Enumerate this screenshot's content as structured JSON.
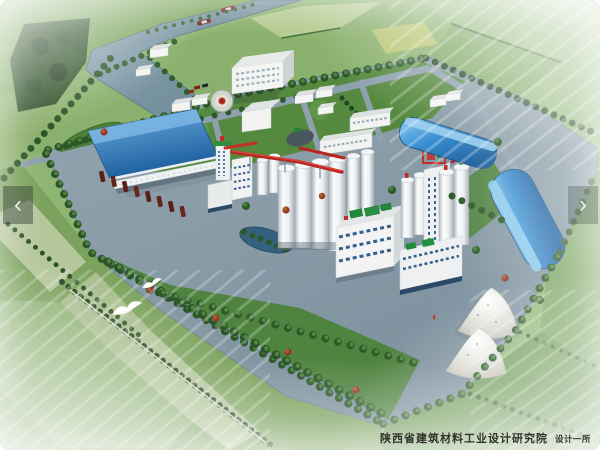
{
  "viewer": {
    "prev_label": "‹",
    "next_label": "›"
  },
  "watermark": {
    "text": "陕西省建筑材料工业设计研究院",
    "suffix": "设计一所",
    "color": "#32322d"
  },
  "scene": {
    "kind": "aerial-3d-architectural-rendering",
    "subject": "bird's-eye rendering of a cement plant campus surrounded by farmland and a canal",
    "elements": [
      "canal-with-barges",
      "harbor-basin",
      "farm-fields",
      "forest-patch",
      "office-building",
      "fountain-plaza",
      "staff-houses",
      "blue-roof-warehouse",
      "loading-docks",
      "truck-row",
      "mill-building",
      "red-conveyor-gallery",
      "cement-silos",
      "packing-plant",
      "preheater-tower",
      "arched-storage-hall-north",
      "arched-storage-hall-east",
      "limestone-stockpiles",
      "pond",
      "tree-lined-roads",
      "flying-birds"
    ],
    "palette": {
      "water": "#7f98a6",
      "roof_blue": "#2f7fc2",
      "arch_blue": "#2d7fc0",
      "paving": "#8799a7",
      "lawn_green": "#55893f",
      "field_green": "#86ad68",
      "field_pale": "#b7c79c",
      "tree_green": "#2d5828",
      "hedge_dark": "#24471f",
      "silo_white": "#eef1f3",
      "conveyor_red": "#b7251e",
      "machinery_green": "#1f8a3a",
      "truck_maroon": "#5d1f18",
      "stockpile_gray": "#d9d9d0",
      "bird_white": "#fdfdfb"
    }
  }
}
